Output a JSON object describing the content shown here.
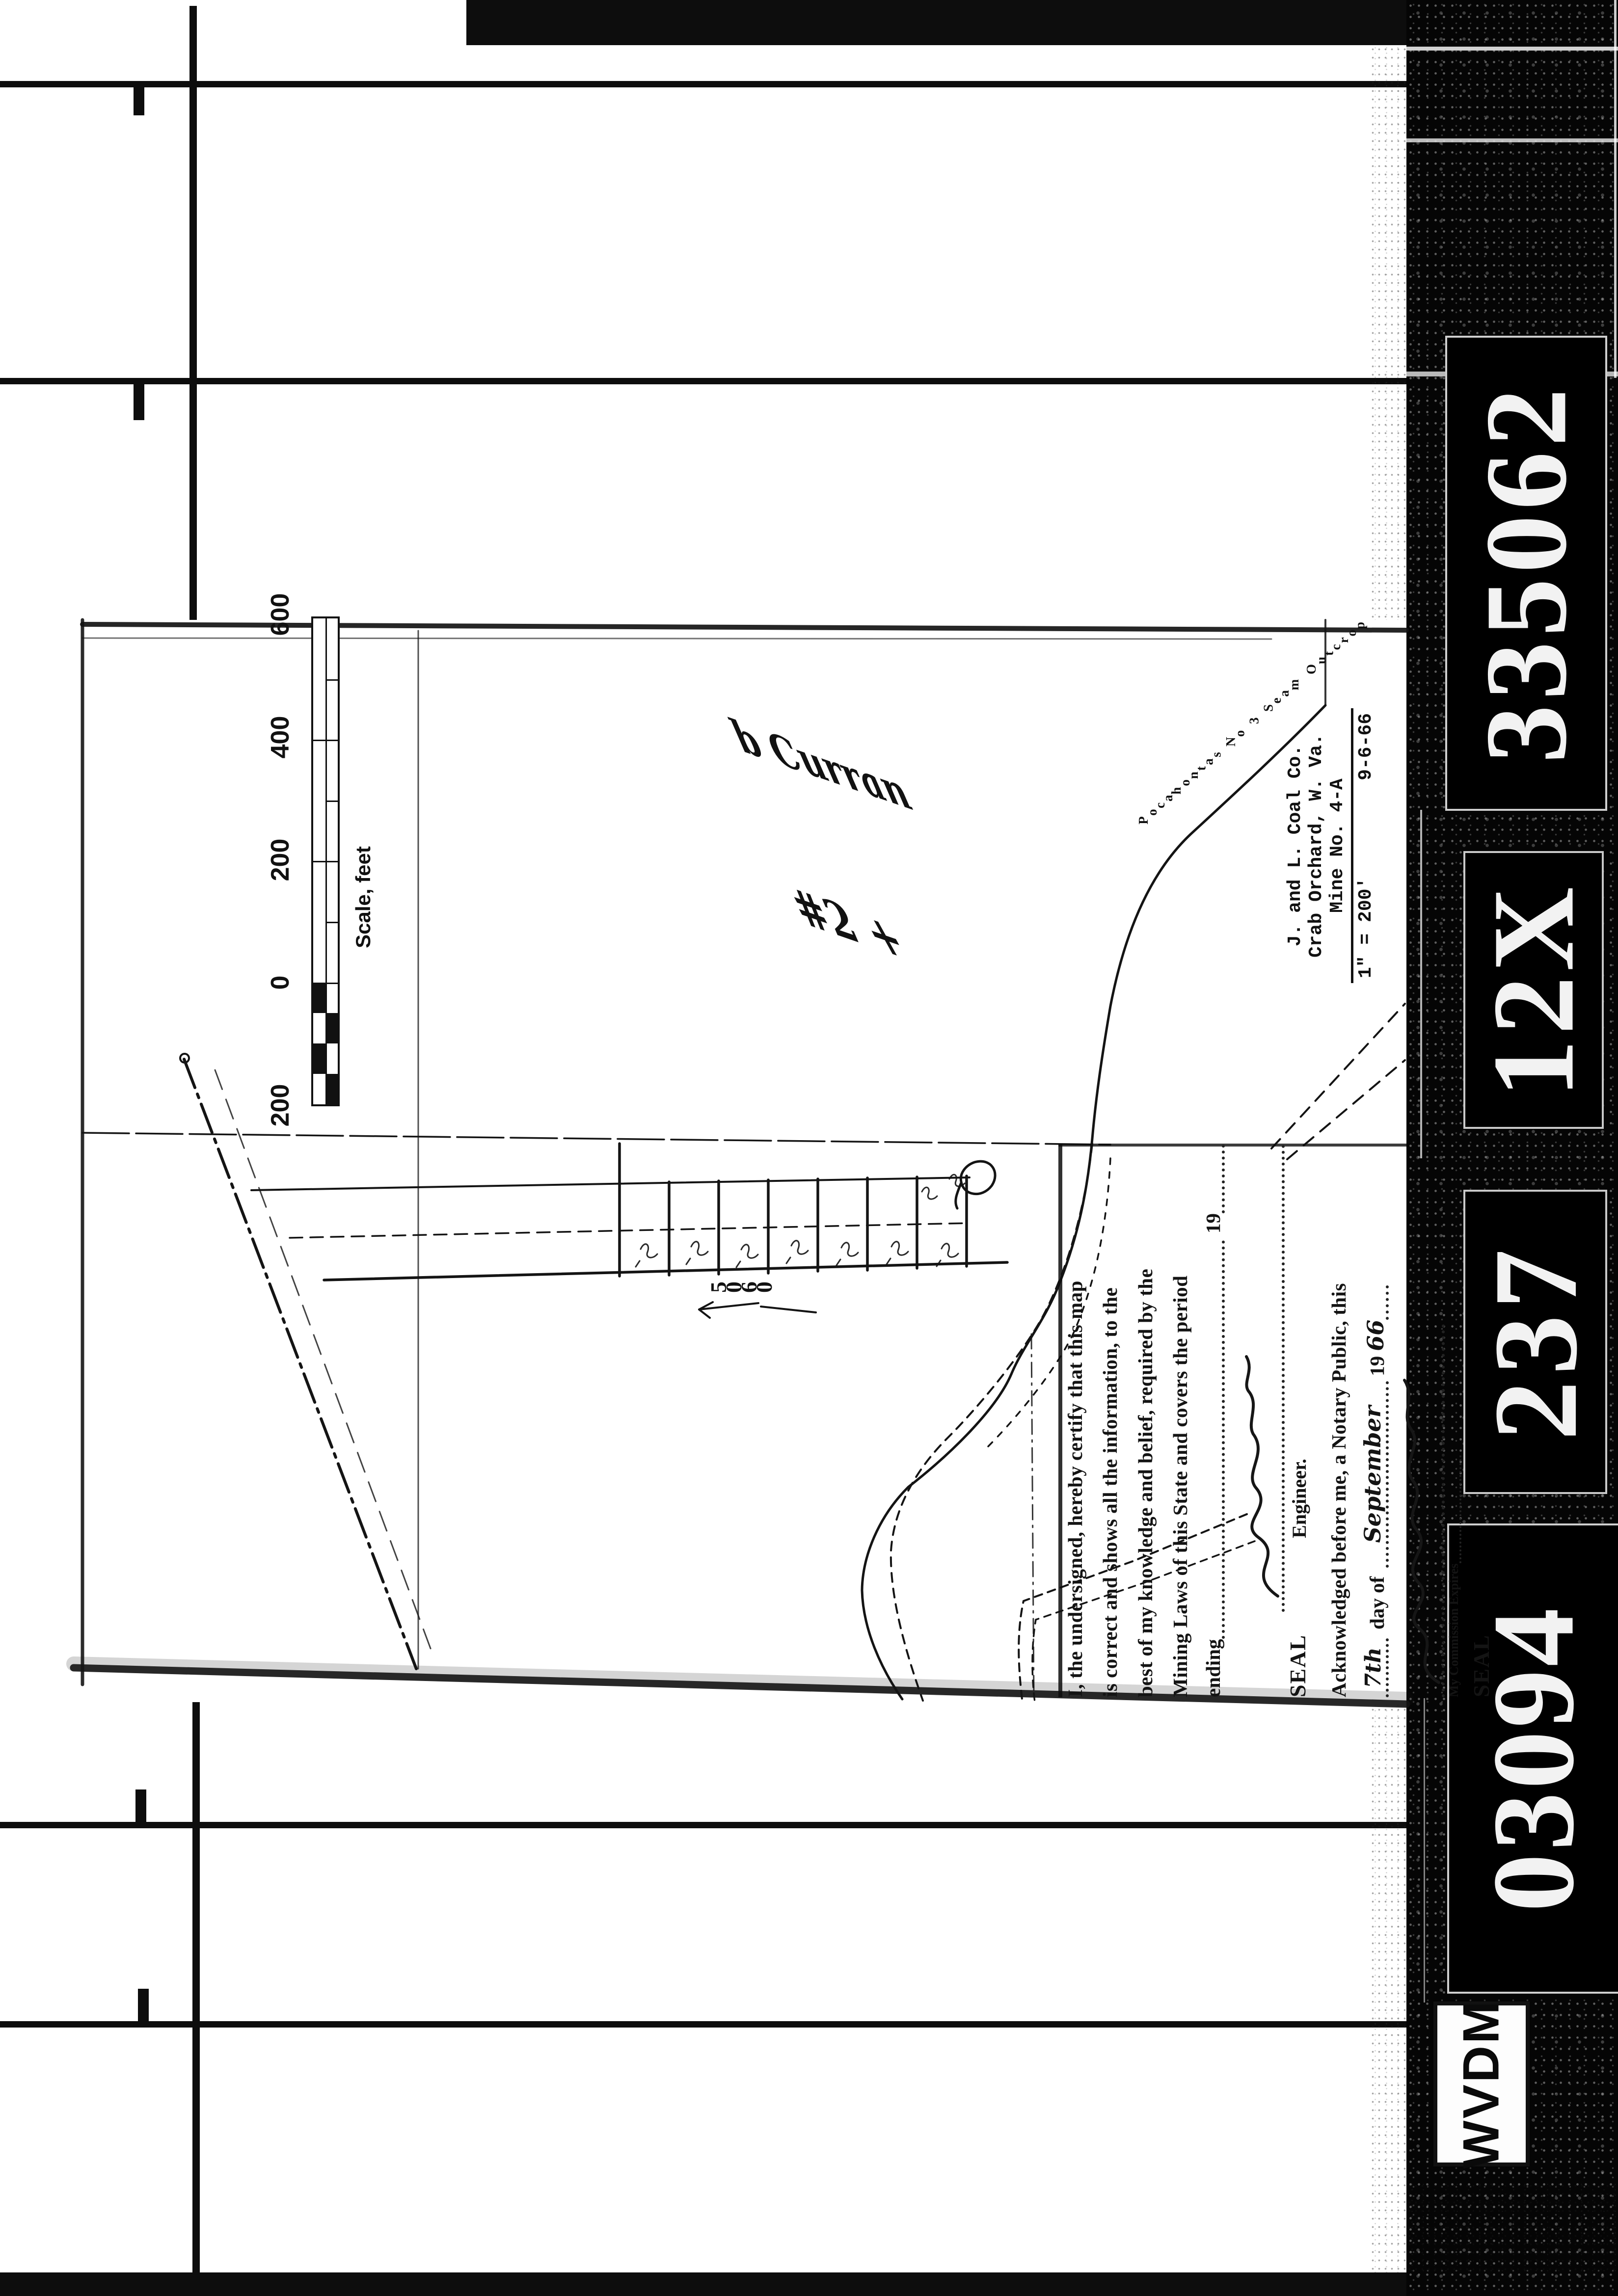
{
  "colors": {
    "paper": "#ffffff",
    "ink": "#111111",
    "film_black": "#000000"
  },
  "film": {
    "id_labels": [
      {
        "text": "335062"
      },
      {
        "text": "12X"
      },
      {
        "text": "237"
      },
      {
        "text": "03094"
      },
      {
        "text": "WVDM"
      }
    ]
  },
  "map": {
    "scale_bar": {
      "tick_labels": [
        "600",
        "400",
        "200",
        "0",
        "200"
      ],
      "caption": "Scale, feet"
    },
    "title_block": {
      "company": "J. and L. Coal Co.",
      "location": "Crab Orchard, W. Va.",
      "mine": "Mine No. 4-A",
      "map_scale": "1\" = 200'",
      "date": "9-6-66"
    },
    "outcrop_label": "Pocahontas No 3 Seam Outcrop",
    "annotations": {
      "elevation": "5060",
      "handwritten_1": "b Curran",
      "handwritten_2": "#2 +",
      "note": "handwritten cursive, partly illegible"
    },
    "certification": {
      "line1": "I, the undersigned, hereby certify that this map",
      "line2": "is correct and shows all the information, to the",
      "line3": "best of my knowledge and belief, required by the",
      "line4": "Mining Laws of this State and covers the period",
      "ending_label": "ending",
      "ending_year_prefix": "19",
      "seal_label": "SEAL",
      "engineer_label": "Engineer.",
      "acknowledged_line": "Acknowledged before me, a Notary Public, this",
      "day_value": "7th",
      "day_of_label": "day of",
      "month_value": "September",
      "ack_year_prefix": "19",
      "ack_year_value": "66",
      "commission_label": "My Commission Expires",
      "seal2_label": "SEAL"
    }
  }
}
